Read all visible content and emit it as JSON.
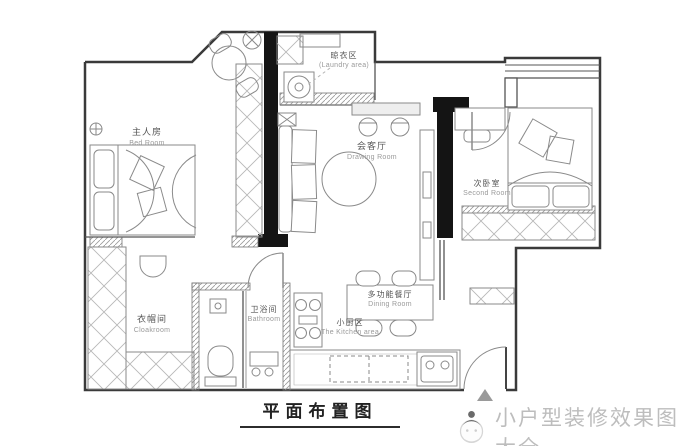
{
  "document": {
    "title": "平面布置图"
  },
  "watermark": {
    "brand": "小户型装修效果图大全",
    "logo": "mascot-with-hat-icon"
  },
  "colors": {
    "wall_black": "#141414",
    "line": "#4a4a4a",
    "furniture_line": "#8a8a8a",
    "hatch": "#b8b8b8",
    "label": "#555555",
    "label_en": "#9a9a9a",
    "watermark_gray": "#bdbdbd"
  },
  "rooms": [
    {
      "id": "master-bedroom",
      "zh": "主人房",
      "en": "Bed Room"
    },
    {
      "id": "laundry-area",
      "zh": "晾衣区",
      "en": "(Laundry area)"
    },
    {
      "id": "living-room",
      "zh": "会客厅",
      "en": "Drawing Room"
    },
    {
      "id": "second-bedroom",
      "zh": "次卧室",
      "en": "Second Room"
    },
    {
      "id": "cloakroom",
      "zh": "衣帽间",
      "en": "Cloakroom"
    },
    {
      "id": "bathroom",
      "zh": "卫浴间",
      "en": "Bathroom"
    },
    {
      "id": "dining-room",
      "zh": "多功能餐厅",
      "en": "Dining Room"
    },
    {
      "id": "kitchen",
      "zh": "小厨区",
      "en": "The Kitchen area"
    }
  ]
}
